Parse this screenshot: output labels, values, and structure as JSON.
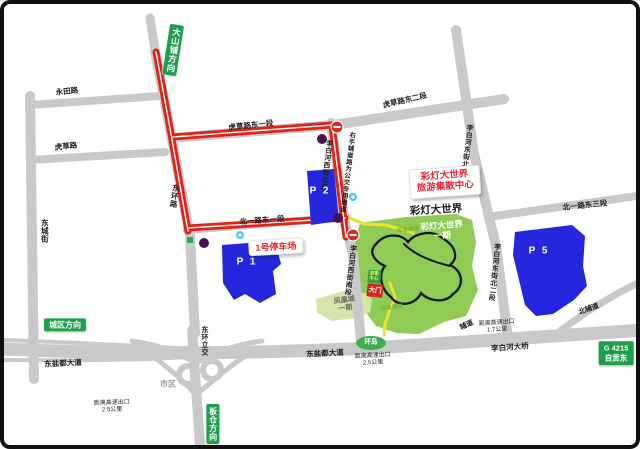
{
  "signs": {
    "dashanpu": "大山铺方向",
    "chengqu": "城区方向",
    "bancang": "板仓方向",
    "g4215_code": "G 4215",
    "g4215_dest": "自贡东"
  },
  "roads": {
    "yongtian": "永田路",
    "hucao": "虎草路",
    "dongcheng": "东城街",
    "donghuan": "东环路",
    "hucao_e1": "虎草路东一段",
    "hucao_e2": "虎草路东二段",
    "beiyilu_e1": "北一路东一段",
    "beiyilu_e3": "北一路东三段",
    "libaihe_xi_bei": "李白河西街北段",
    "libaihe_xi_nan": "李白河西街南段",
    "libaihe_dong_bei1": "李白河东街北一段",
    "libaihe_dong_bei2": "李白河东街北二段",
    "bus_lane_note": "右手辅道路为公交专用通道",
    "dongyandu_w": "东盐都大道",
    "dongyandu_c": "东盐都大道",
    "libaihe_bridge": "李白河大桥",
    "beifudao": "北辅道",
    "fudao": "辅道",
    "donghuan_lijiao": "东环立交",
    "shiqu": "市区",
    "huandao": "环岛"
  },
  "notes": {
    "exit_label": "距离高速出口",
    "exit_17": "1.7公里",
    "exit_25": "2.5公里"
  },
  "areas": {
    "park_title": "彩灯大世界",
    "park_name": "彩灯大世界",
    "park_phase": "一期",
    "hub_1": "彩灯大世界",
    "hub_2": "旅游集散中心",
    "fenghuang_1": "凤凰城",
    "fenghuang_2": "一期",
    "gate": "大门",
    "visitor_1": "游客",
    "visitor_2": "中心",
    "emergency_path": "应急通道"
  },
  "parking": {
    "p1": "P 1",
    "p2": "P 2",
    "p5": "P 5",
    "p1_callout": "1号停车场"
  },
  "colors": {
    "route_red": "#df2319",
    "road_gray": "#c9c9c9",
    "parking_blue": "#2427de",
    "park_green": "#8fcb55",
    "sign_green": "#1f9e4c",
    "marker_purple": "#4a1150",
    "marker_cyan": "#45c8e8"
  }
}
